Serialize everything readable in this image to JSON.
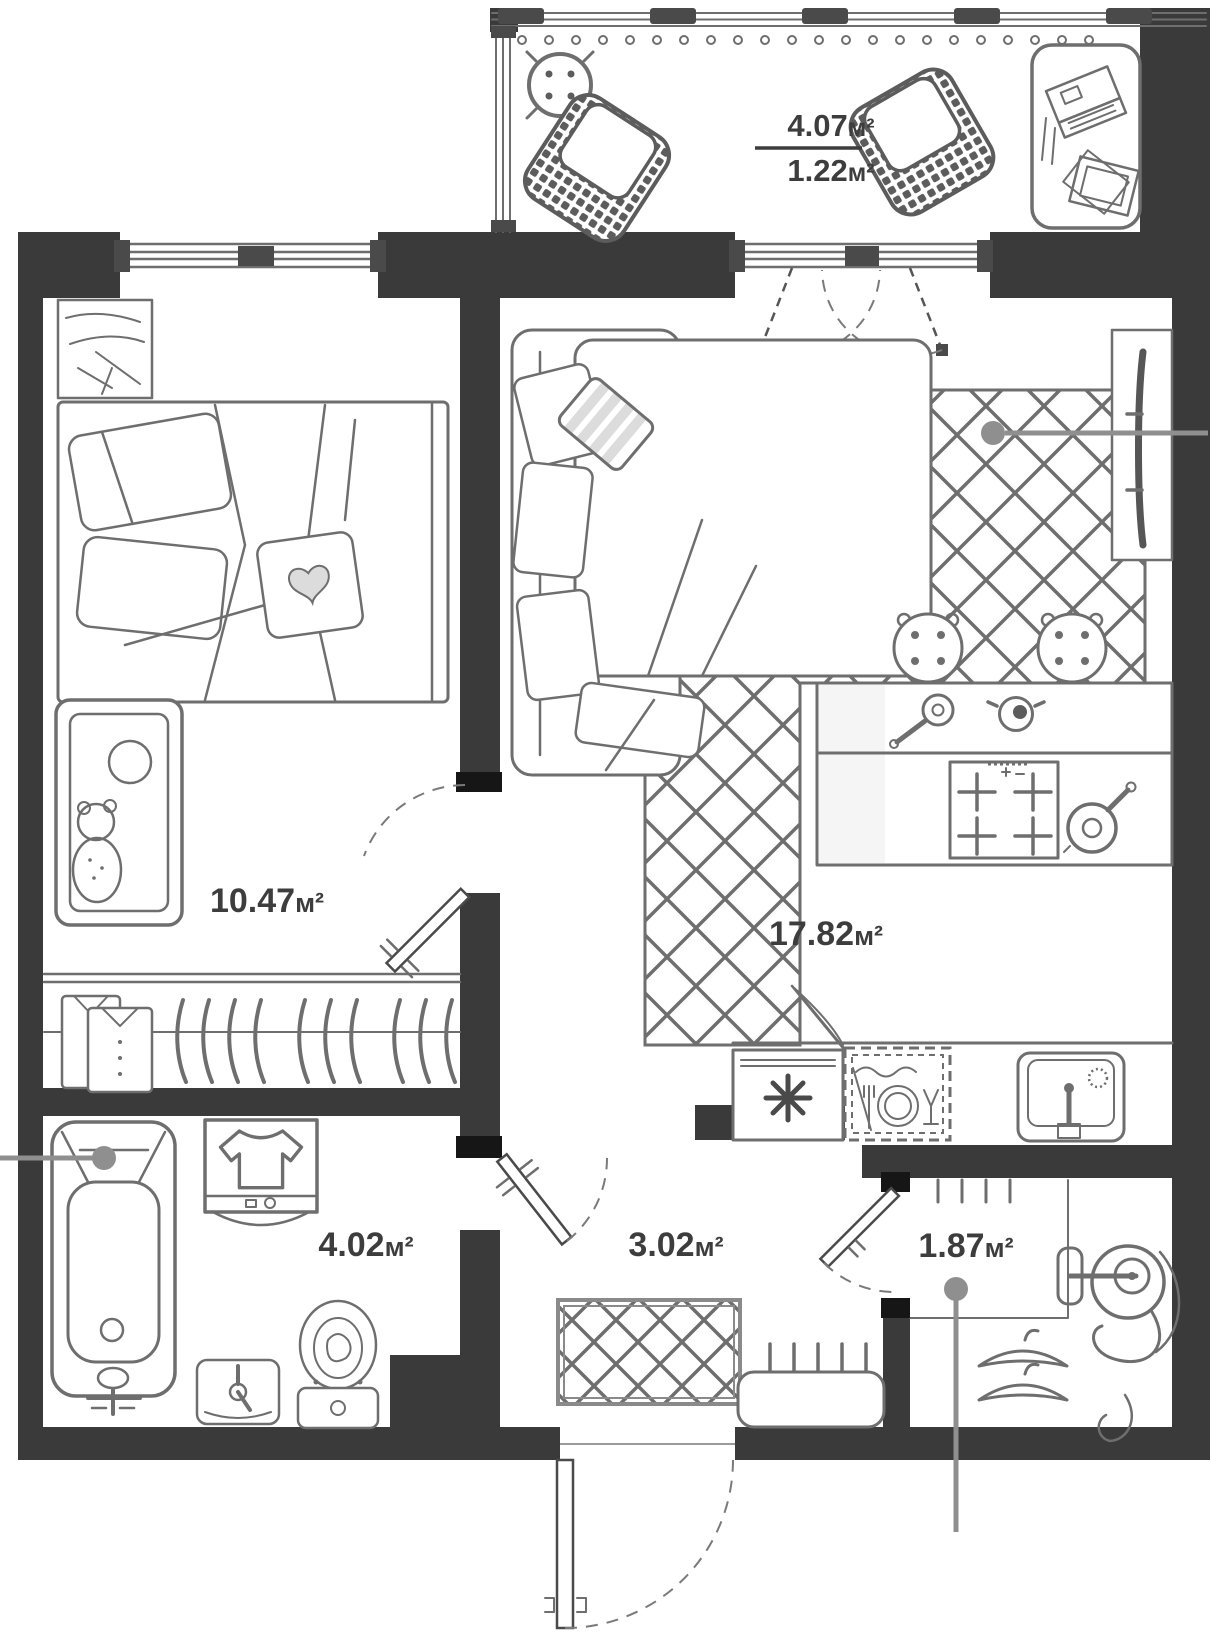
{
  "rooms": {
    "balcony": {
      "area_value": "4.07",
      "area_unit": "м²",
      "reduced_area_value": "1.22",
      "reduced_area_unit": "м²"
    },
    "bedroom": {
      "area_value": "10.47",
      "area_unit": "м²"
    },
    "living_kitchen": {
      "area_value": "17.82",
      "area_unit": "м²"
    },
    "bathroom": {
      "area_value": "4.02",
      "area_unit": "м²"
    },
    "hallway": {
      "area_value": "3.02",
      "area_unit": "м²"
    },
    "storage": {
      "area_value": "1.87",
      "area_unit": "м²"
    }
  },
  "furniture_icons": [
    "double-bed",
    "bedside-table",
    "baby-crib",
    "teddy-bear",
    "wardrobe-shirts",
    "wardrobe-hangers",
    "corner-sofa",
    "pillows",
    "area-rug",
    "tv-panel",
    "kitchen-island",
    "bar-stools",
    "saucepan",
    "pot",
    "cooktop",
    "frying-pan",
    "refrigerator",
    "dishwasher",
    "kitchen-sink",
    "bathtub",
    "washing-machine",
    "bathroom-sink",
    "toilet",
    "doormat",
    "shoe-bench",
    "entrance-door",
    "coat-rail",
    "clothes-hangers",
    "vacuum-cleaner",
    "round-table",
    "rattan-chairs",
    "work-desk",
    "laptop",
    "books"
  ],
  "colors": {
    "wall": "#3a3a3a",
    "furniture_line": "#6e6e6e",
    "label_text": "#3d3d3d",
    "leader": "#8f8f8f",
    "stripe_light": "#dcdcdc",
    "window_frame": "#4a4a4a",
    "hinge": "#161616",
    "page_bg": "#ffffff"
  }
}
